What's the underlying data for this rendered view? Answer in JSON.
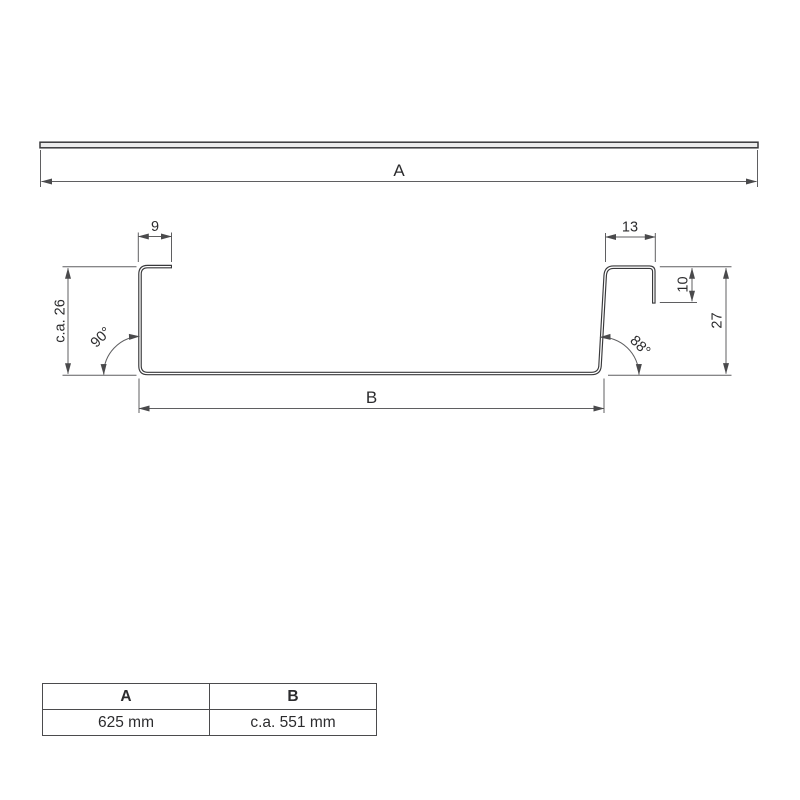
{
  "drawing": {
    "labels": {
      "overall_width": "A",
      "base_width": "B",
      "left_lip_width": "9",
      "right_lip_width": "13",
      "right_lip_depth": "10",
      "left_height": "c.a. 26",
      "right_height": "27",
      "left_angle": "90°",
      "right_angle": "88°"
    },
    "colors": {
      "profile_line": "#39393b",
      "dimension_line": "#5f5f61",
      "text": "#2c2c2e",
      "sheet_fill": "#ececec"
    }
  },
  "table": {
    "headers": [
      "A",
      "B"
    ],
    "rows": [
      [
        "625 mm",
        "c.a. 551 mm"
      ]
    ]
  }
}
